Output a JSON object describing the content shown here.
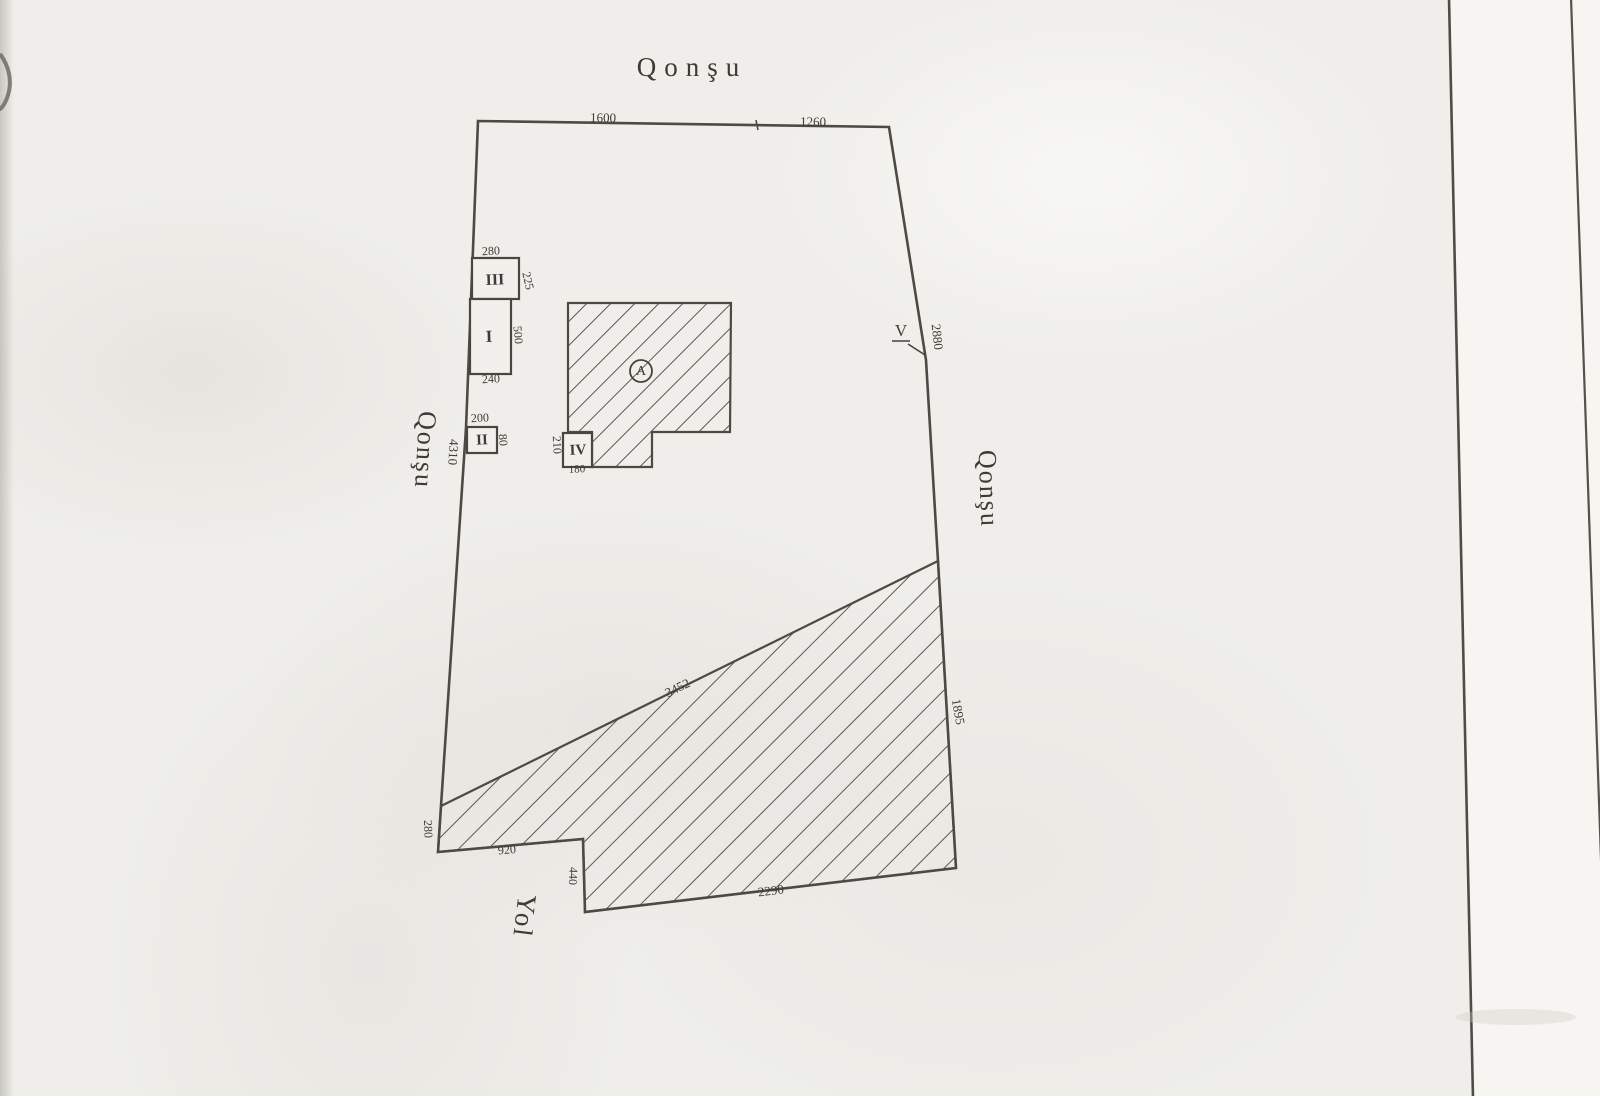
{
  "plan": {
    "labels": {
      "neighbor_top": "Qonşu",
      "neighbor_left": "Qonşu",
      "neighbor_right": "Qonşu",
      "road": "Yol",
      "building": "A",
      "point_v": "V"
    },
    "dims": {
      "top_segment_1": "1600",
      "top_segment_2": "1260",
      "right_upper": "2880",
      "left_side": "4310",
      "diagonal": "3452",
      "right_lower": "1895",
      "bottom": "2290",
      "step": "440",
      "bottom_left": "920",
      "corner": "280"
    },
    "structures": [
      {
        "label": "III",
        "top": "280",
        "side": "225"
      },
      {
        "label": "I",
        "side": "500",
        "bottom": "240"
      },
      {
        "label": "II",
        "top": "200",
        "side": "80"
      },
      {
        "label": "IV",
        "side": "210",
        "bottom": "180"
      }
    ],
    "colors": {
      "ink": "#4a463f",
      "paper": "#efeeea",
      "hatch": "#5c5850"
    }
  }
}
